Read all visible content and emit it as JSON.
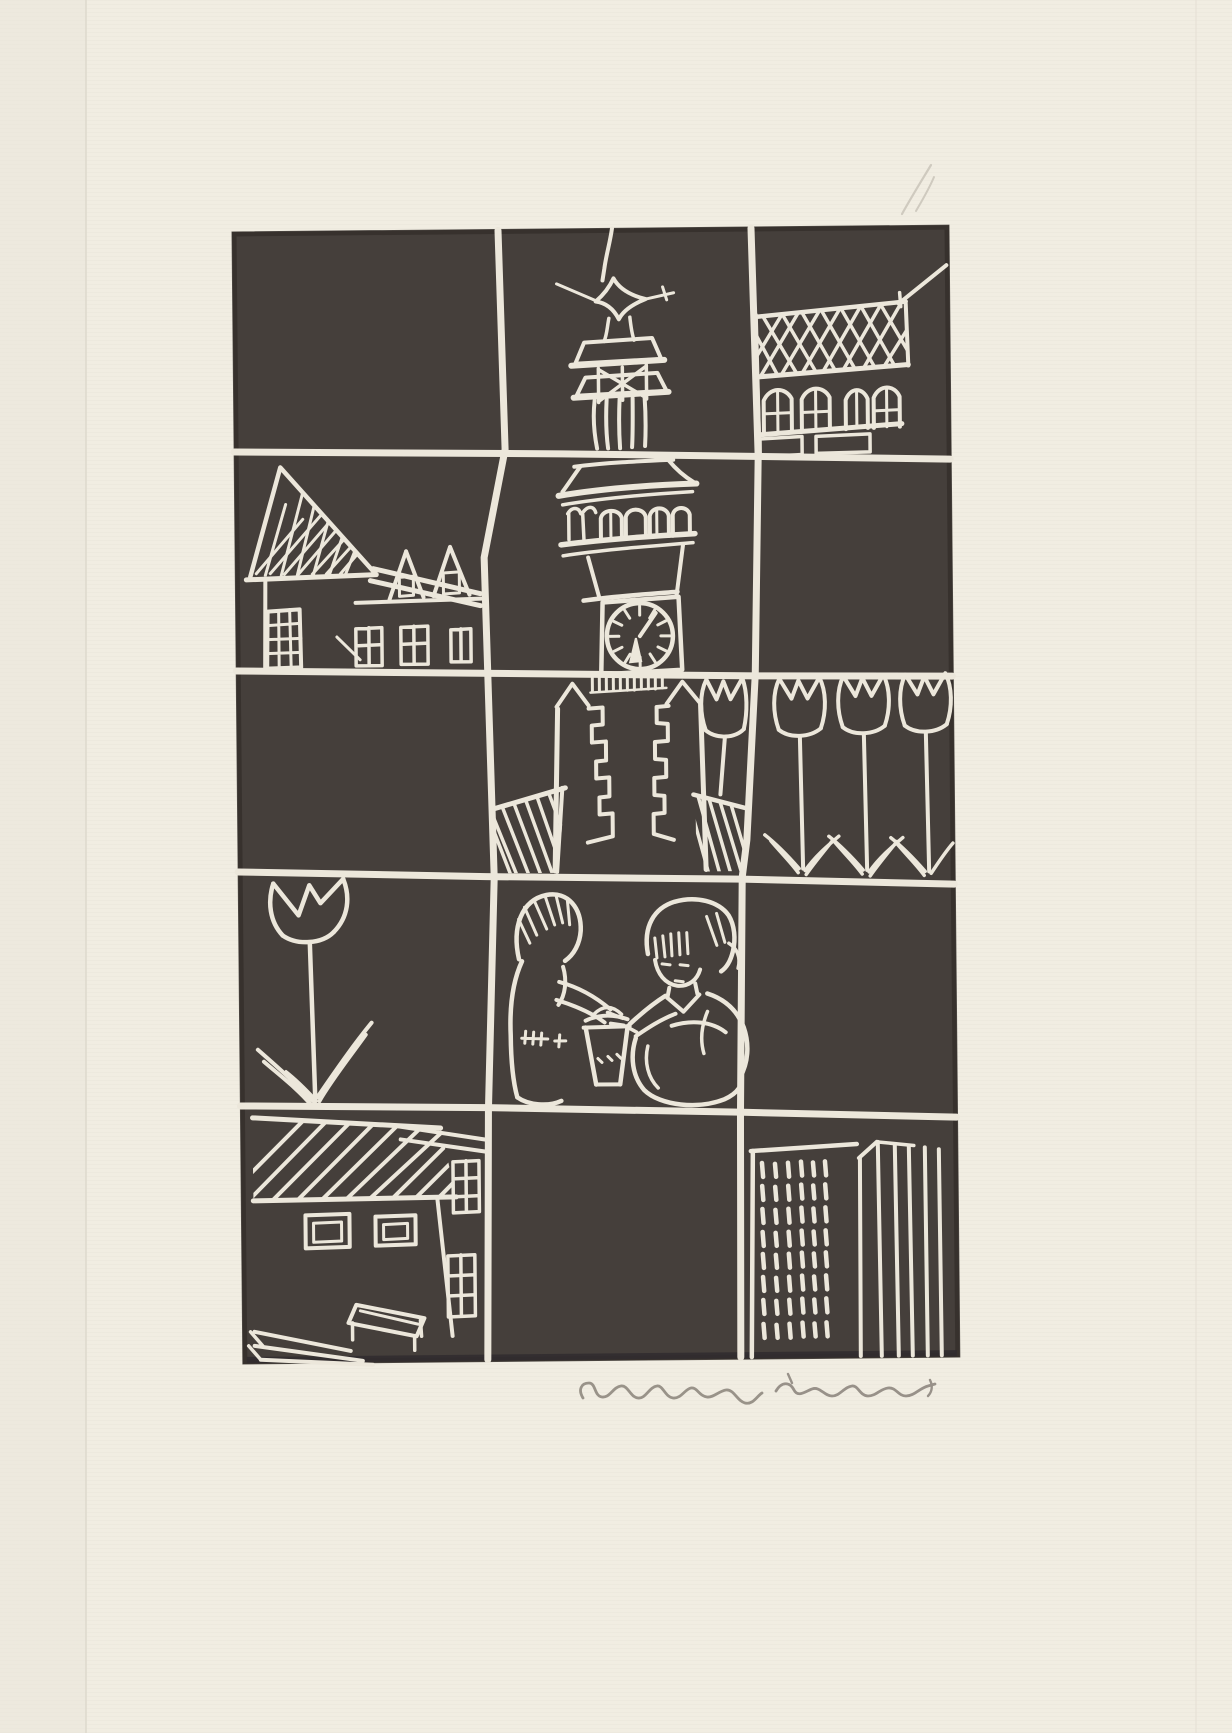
{
  "artwork": {
    "title": "Linocut print: grid of town vignettes with clock tower, houses, tulips and children",
    "medium": "linocut, dark brown-black ink on cream laid paper",
    "grid": {
      "columns": 3,
      "rows": 5
    },
    "panels": [
      "empty dark sky",
      "tower spire with star finial",
      "house with cross-hatched roof, four arched windows and chimney",
      "gabled house with lattice gable, two dormers and paned windows",
      "clock tower belfry and clock face",
      "empty dark",
      "empty dark",
      "tower base with crenellated turrets and hatched side roofs",
      "row of four tulips",
      "single large tulip",
      "two children playing with a bucket",
      "empty dark",
      "village house with hatched roof, windows and bench",
      "empty dark",
      "high-rise with dashed window grid beside striped tower block"
    ],
    "signature": {
      "text": "(illegible pencil signature)",
      "position": "on paper margin below lower-right of print"
    },
    "colors": {
      "paper": "#f1ede2",
      "paper_edge": "#eae6da",
      "ink": "#453f3b",
      "ink_edge": "#332e2b",
      "cut": "#ece7db",
      "graphite": "#8f8880"
    }
  }
}
